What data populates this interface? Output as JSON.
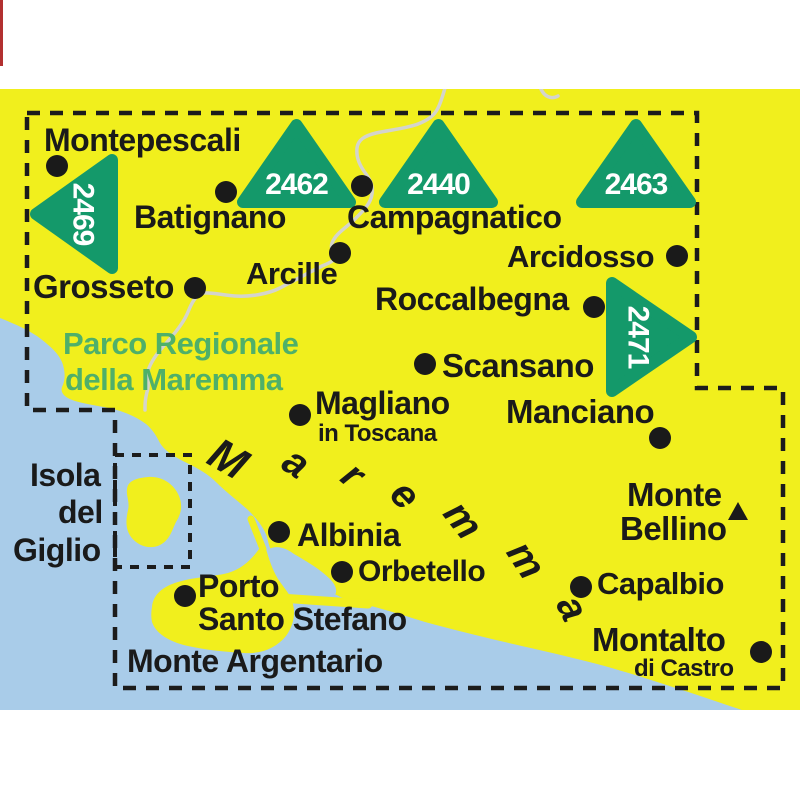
{
  "page": {
    "background": "#ffffff"
  },
  "map": {
    "area": {
      "x": 0,
      "y": 89,
      "w": 800,
      "h": 621
    },
    "colors": {
      "land": "#f1ef1d",
      "sea": "#a9cce9",
      "triangle_green": "#14996a",
      "label_black": "#1a1a1a",
      "park_green": "#4fb069",
      "river_gray": "#d4d4cc",
      "boundary_black": "#1c1c1c",
      "red_strip": "#b23030",
      "white": "#ffffff"
    },
    "sheet_boundary": {
      "points": "27,113 697,113 697,388 783,388 783,688 115,688 115,410 27,410"
    },
    "giglio_inset_box": {
      "x": 115,
      "y": 455,
      "w": 75,
      "h": 112
    },
    "shapes": {
      "sea": "M0,318 C15,324 31,331 41,339 C51,347 58,353 62,362 C65,370 66,379 62,387 C60,393 65,398 75,401 C89,405 101,406 113,409 C125,412 137,417 146,424 C152,429 156,435 160,443 C165,451 173,456 187,463 C199,469 208,474 217,483 C226,492 238,501 248,510 C256,518 263,526 267,537 C269,545 270,551 275,555 C283,561 293,566 303,573 C313,580 323,587 333,593 C343,599 353,602 367,605 C383,609 403,615 425,622 C447,628 471,634 496,640 C521,646 546,651 573,658 C599,664 626,672 651,680 C676,688 701,696 721,703 C733,707 742,710 748,712 L0,712 Z",
      "river": "M445,88 C442,98 441,102 438,108 C434,116 428,120 418,124 C408,128 390,130 376,133 C364,136 358,140 357,148 C356,158 360,166 366,174 C371,181 373,186 372,194 C371,203 364,210 355,219 C346,228 336,233 332,243 C330,250 334,252 337,255 C338,258 332,262 322,266 C310,272 295,280 280,288 C268,294 250,297 235,296 C222,295 210,292 203,293 C196,295 192,302 188,312 C184,322 176,332 168,341 C160,350 153,358 149,368 C146,376 150,384 147,392 C145,400 145,404 145,410",
      "river_stub": "M541,89 C544,96 551,100 558,96",
      "giglio_island": "M148,477 C162,476 174,484 179,496 C183,506 181,514 176,522 C172,530 170,540 160,545 C150,550 138,546 131,537 C125,529 126,519 128,510 C130,502 126,496 127,489 C128,480 138,478 148,477 Z",
      "argentario": "M152,607 C153,594 164,586 178,582 C194,577 212,577 228,573 C242,569 252,559 259,549 L266,549 C269,559 272,569 278,579 C284,588 290,594 292,601 C296,612 294,625 286,636 C276,648 262,654 244,653 C226,652 206,650 188,646 C170,642 156,634 152,622 C151,617 151,612 152,607 Z",
      "lagoon": "M269,549 C277,545 286,548 294,554 C306,561 320,569 330,579 C337,586 338,594 333,596 C325,598 312,592 300,584 C288,576 277,566 271,558 C268,554 267,551 269,549 Z",
      "spits": [
        {
          "d": "M251,519 L263,549",
          "w": 7
        },
        {
          "d": "M280,598 L368,604",
          "w": 9
        }
      ]
    },
    "triangles": [
      {
        "number": "2469",
        "direction": "left",
        "x": 36,
        "y": 160,
        "w": 76,
        "h": 108
      },
      {
        "number": "2462",
        "direction": "up",
        "x": 243,
        "y": 125,
        "w": 107,
        "h": 77
      },
      {
        "number": "2440",
        "direction": "up",
        "x": 385,
        "y": 125,
        "w": 107,
        "h": 77
      },
      {
        "number": "2463",
        "direction": "up",
        "x": 582,
        "y": 125,
        "w": 108,
        "h": 77
      },
      {
        "number": "2471",
        "direction": "right",
        "x": 612,
        "y": 283,
        "w": 79,
        "h": 108
      }
    ],
    "towns": [
      {
        "id": "montepescali",
        "label": "Montepescali",
        "x": 44,
        "y": 151,
        "size": 32,
        "dot": {
          "x": 57,
          "y": 166
        }
      },
      {
        "id": "batignano",
        "label": "Batignano",
        "x": 134,
        "y": 228,
        "size": 32,
        "dot": {
          "x": 226,
          "y": 192
        }
      },
      {
        "id": "campagnatico",
        "label": "Campagnatico",
        "x": 347,
        "y": 228,
        "size": 32,
        "dot": {
          "x": 362,
          "y": 186
        }
      },
      {
        "id": "arcidosso",
        "label": "Arcidosso",
        "x": 507,
        "y": 267,
        "size": 31,
        "dot": {
          "x": 677,
          "y": 256
        }
      },
      {
        "id": "grosseto",
        "label": "Grosseto",
        "x": 33,
        "y": 298,
        "size": 33,
        "dot": {
          "x": 195,
          "y": 288
        }
      },
      {
        "id": "arcille",
        "label": "Arcille",
        "x": 246,
        "y": 284,
        "size": 31,
        "dot": {
          "x": 340,
          "y": 253
        }
      },
      {
        "id": "roccalbegna",
        "label": "Roccalbegna",
        "x": 375,
        "y": 310,
        "size": 32,
        "dot": {
          "x": 594,
          "y": 307
        }
      },
      {
        "id": "scansano",
        "label": "Scansano",
        "x": 442,
        "y": 377,
        "size": 33,
        "dot": {
          "x": 425,
          "y": 364
        }
      },
      {
        "id": "magliano",
        "label": "Magliano",
        "x": 315,
        "y": 414,
        "size": 32,
        "dot": {
          "x": 300,
          "y": 415
        },
        "sub": {
          "label": "in Toscana",
          "x": 318,
          "y": 441,
          "size": 24
        }
      },
      {
        "id": "manciano",
        "label": "Manciano",
        "x": 506,
        "y": 423,
        "size": 33,
        "dot": {
          "x": 660,
          "y": 438
        }
      },
      {
        "id": "albinia",
        "label": "Albinia",
        "x": 297,
        "y": 546,
        "size": 32,
        "dot": {
          "x": 279,
          "y": 532
        }
      },
      {
        "id": "orbetello",
        "label": "Orbetello",
        "x": 358,
        "y": 581,
        "size": 30,
        "dot": {
          "x": 342,
          "y": 572
        }
      },
      {
        "id": "porto-santo-stefano",
        "label": "Porto",
        "x": 198,
        "y": 597,
        "size": 32,
        "dot": {
          "x": 185,
          "y": 596
        },
        "sub": {
          "label": "Santo Stefano",
          "x": 198,
          "y": 630,
          "size": 32
        }
      },
      {
        "id": "monte-argentario",
        "label": "Monte Argentario",
        "x": 127,
        "y": 672,
        "size": 32
      },
      {
        "id": "monte-bellino",
        "label": "Monte",
        "x": 627,
        "y": 506,
        "size": 33,
        "sub": {
          "label": "Bellino",
          "x": 620,
          "y": 540,
          "size": 33
        },
        "peak": {
          "x": 738,
          "y": 511
        }
      },
      {
        "id": "capalbio",
        "label": "Capalbio",
        "x": 597,
        "y": 594,
        "size": 31,
        "dot": {
          "x": 581,
          "y": 587
        }
      },
      {
        "id": "montalto",
        "label": "Montalto",
        "x": 592,
        "y": 651,
        "size": 33,
        "dot": {
          "x": 761,
          "y": 652
        },
        "sub": {
          "label": "di Castro",
          "x": 634,
          "y": 676,
          "size": 24
        }
      }
    ],
    "park_label": {
      "size": 31,
      "lines": [
        {
          "text": "Parco Regionale",
          "x": 63,
          "y": 354
        },
        {
          "text": "della Maremma",
          "x": 65,
          "y": 390
        }
      ]
    },
    "island_label": {
      "size": 32,
      "lines": [
        {
          "text": "Isola",
          "x": 30,
          "y": 486
        },
        {
          "text": "del",
          "x": 58,
          "y": 523
        },
        {
          "text": "Giglio",
          "x": 13,
          "y": 561
        }
      ]
    },
    "sea_label": {
      "word": "Maremma",
      "letters": [
        {
          "ch": "M",
          "x": 228,
          "y": 459,
          "rot": 30,
          "size": 44
        },
        {
          "ch": "a",
          "x": 296,
          "y": 463,
          "rot": 34,
          "size": 40
        },
        {
          "ch": "r",
          "x": 353,
          "y": 475,
          "rot": 40,
          "size": 40
        },
        {
          "ch": "e",
          "x": 405,
          "y": 495,
          "rot": 46,
          "size": 40
        },
        {
          "ch": "m",
          "x": 463,
          "y": 520,
          "rot": 52,
          "size": 40
        },
        {
          "ch": "m",
          "x": 526,
          "y": 560,
          "rot": 57,
          "size": 40
        },
        {
          "ch": "a",
          "x": 572,
          "y": 608,
          "rot": 63,
          "size": 40
        }
      ]
    },
    "dot_radius": 11,
    "decor": {
      "red_strip": {
        "x": 0,
        "y": 0,
        "w": 3,
        "h": 66
      }
    }
  }
}
